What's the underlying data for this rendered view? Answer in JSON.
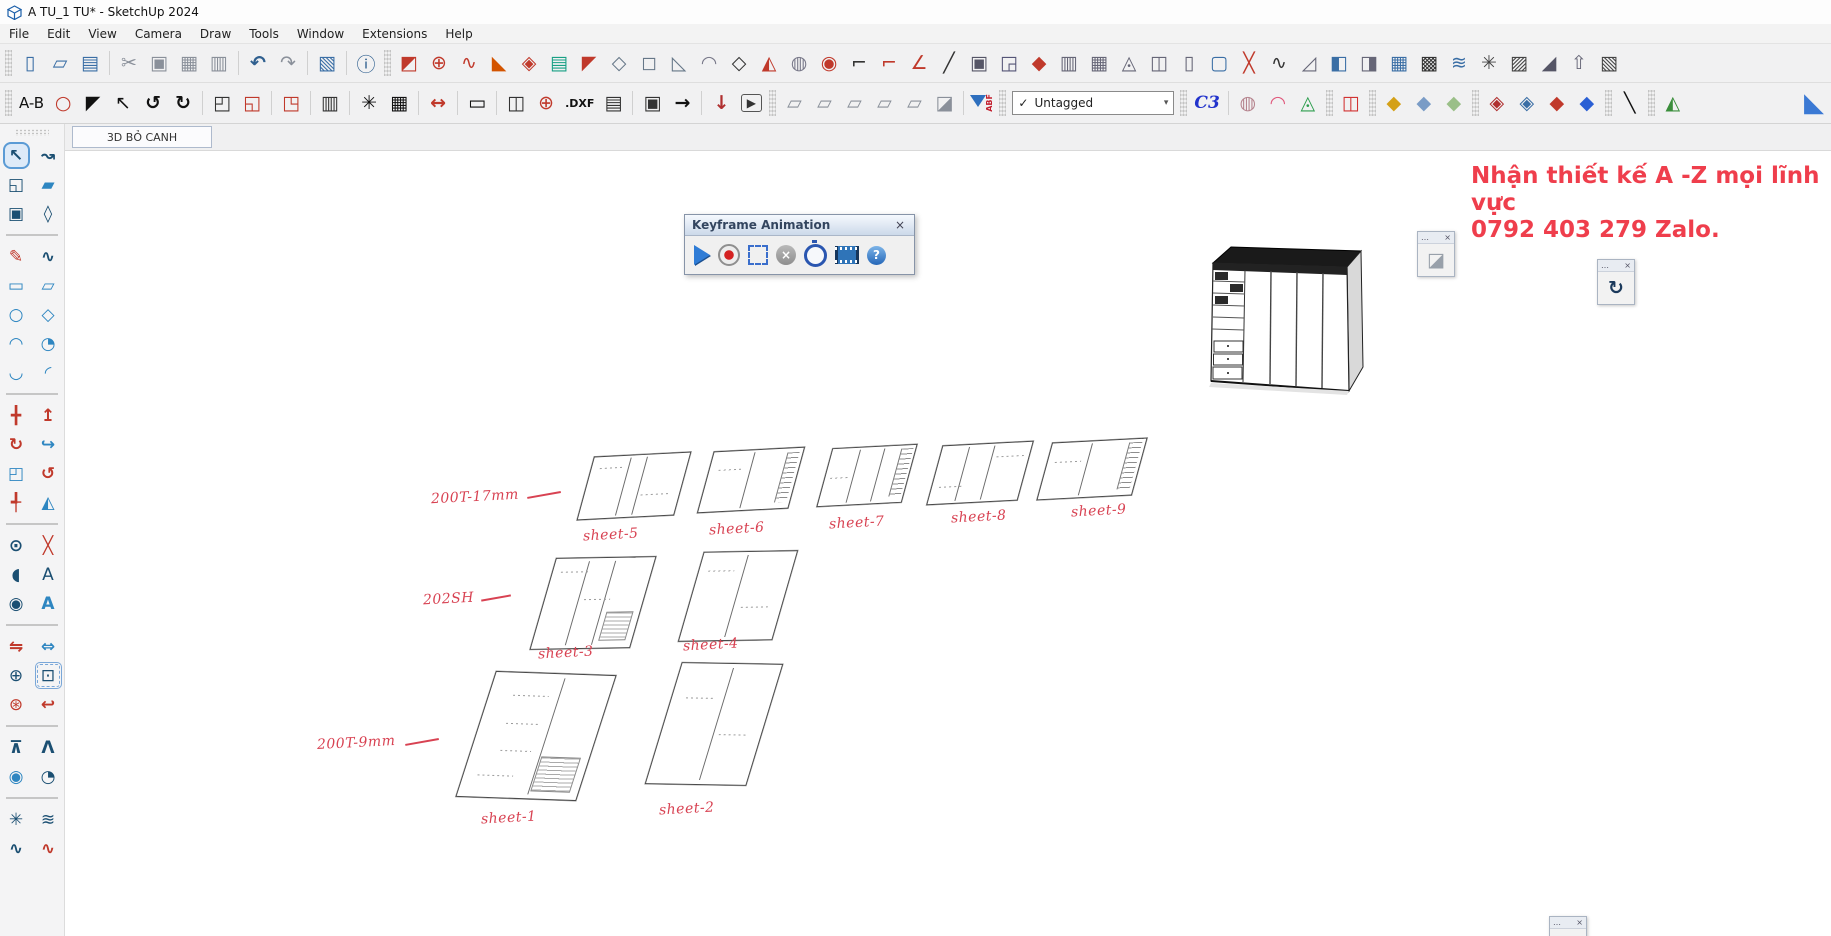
{
  "window": {
    "title": "A TU_1 TU* - SketchUp 2024"
  },
  "menubar": {
    "items": [
      "File",
      "Edit",
      "View",
      "Camera",
      "Draw",
      "Tools",
      "Window",
      "Extensions",
      "Help"
    ]
  },
  "toolbar_main": {
    "items": [
      {
        "t": "grip"
      },
      {
        "n": "new-file",
        "g": "▯",
        "c": "#3a6ea5"
      },
      {
        "n": "open-folder",
        "g": "▱",
        "c": "#3a6ea5"
      },
      {
        "n": "save",
        "g": "▤",
        "c": "#3a6ea5"
      },
      {
        "t": "sep"
      },
      {
        "n": "cut",
        "g": "✂",
        "c": "#8a909a"
      },
      {
        "n": "copy",
        "g": "▣",
        "c": "#8a909a"
      },
      {
        "n": "paste",
        "g": "▦",
        "c": "#8a909a"
      },
      {
        "n": "delete",
        "g": "▥",
        "c": "#8a909a"
      },
      {
        "t": "sep"
      },
      {
        "n": "undo",
        "g": "↶",
        "c": "#2f5f8f",
        "b": 1
      },
      {
        "n": "redo",
        "g": "↷",
        "c": "#8a909a"
      },
      {
        "t": "sep"
      },
      {
        "n": "print",
        "g": "▧",
        "c": "#3a6ea5"
      },
      {
        "t": "sep"
      },
      {
        "n": "model-info",
        "g": "ⓘ",
        "c": "#2f5f8f"
      },
      {
        "t": "grip"
      },
      {
        "n": "paste-in-place",
        "g": "◩",
        "c": "#c0392b"
      },
      {
        "n": "arc-add",
        "g": "⊕",
        "c": "#c0392b"
      },
      {
        "n": "bezier-curve",
        "g": "∿",
        "c": "#c0392b"
      },
      {
        "n": "eraser-wedge",
        "g": "◣",
        "c": "#d35400"
      },
      {
        "n": "weld-check",
        "g": "◈",
        "c": "#c0392b"
      },
      {
        "n": "layers-stack",
        "g": "▤",
        "c": "#18a085"
      },
      {
        "n": "axe-tool",
        "g": "◤",
        "c": "#c0392b"
      },
      {
        "n": "dashed-outline",
        "g": "◇",
        "c": "#667788"
      },
      {
        "n": "solid-blob",
        "g": "◻",
        "c": "#667788"
      },
      {
        "n": "blob-cut",
        "g": "◺",
        "c": "#667788"
      },
      {
        "n": "pipe-curve",
        "g": "◠",
        "c": "#778"
      },
      {
        "n": "wire-diamond",
        "g": "◇",
        "c": "#333"
      },
      {
        "n": "wedge-red",
        "g": "◭",
        "c": "#c0392b"
      },
      {
        "n": "cylinder-tool",
        "g": "◍",
        "c": "#778"
      },
      {
        "n": "sphere-pull",
        "g": "◉",
        "c": "#c0392b"
      },
      {
        "n": "corner-line",
        "g": "⌐",
        "c": "#333"
      },
      {
        "n": "corner-angle",
        "g": "⌐",
        "c": "#c0392b"
      },
      {
        "n": "angle-tool",
        "g": "∠",
        "c": "#c0392b"
      },
      {
        "n": "curve-swoosh",
        "g": "╱",
        "c": "#333"
      },
      {
        "n": "cube-frame",
        "g": "▣",
        "c": "#556"
      },
      {
        "n": "panel-fold",
        "g": "◲",
        "c": "#557"
      },
      {
        "n": "diamond-red",
        "g": "◆",
        "c": "#c0392b"
      },
      {
        "n": "columns-3d",
        "g": "▥",
        "c": "#667"
      },
      {
        "n": "pillars-3d",
        "g": "▦",
        "c": "#667"
      },
      {
        "n": "brush-fan",
        "g": "◬",
        "c": "#667"
      },
      {
        "n": "panel-pair",
        "g": "◫",
        "c": "#667"
      },
      {
        "n": "door-panel",
        "g": "▯",
        "c": "#667"
      },
      {
        "n": "frame-blue",
        "g": "▢",
        "c": "#3a6ea5"
      },
      {
        "n": "screw-cross",
        "g": "╳",
        "c": "#c0392b"
      },
      {
        "n": "zigzag-tool",
        "g": "∿",
        "c": "#333"
      },
      {
        "n": "ramp-3d",
        "g": "◿",
        "c": "#667"
      },
      {
        "n": "window-frame",
        "g": "◧",
        "c": "#3a6ea5"
      },
      {
        "n": "door-frame",
        "g": "◨",
        "c": "#667"
      },
      {
        "n": "building-3d",
        "g": "▦",
        "c": "#3a6ea5"
      },
      {
        "n": "weave-grid",
        "g": "▩",
        "c": "#333"
      },
      {
        "n": "chevron-stack",
        "g": "≋",
        "c": "#3a6ea5"
      },
      {
        "n": "knot-tool",
        "g": "✳",
        "c": "#444"
      },
      {
        "n": "slope-hatch",
        "g": "▨",
        "c": "#444"
      },
      {
        "n": "fan-lines",
        "g": "◢",
        "c": "#556"
      },
      {
        "n": "fold-arrow",
        "g": "⇧",
        "c": "#667"
      },
      {
        "n": "diag-hatch",
        "g": "▧",
        "c": "#444"
      }
    ]
  },
  "toolbar_second": {
    "items": [
      {
        "t": "grip"
      },
      {
        "t": "text",
        "n": "ab-label",
        "text": "A-B",
        "cls": "ab"
      },
      {
        "n": "zoom-region",
        "g": "○",
        "c": "#c0392b"
      },
      {
        "n": "stamp-tool",
        "g": "◤",
        "c": "#111"
      },
      {
        "n": "cursor-tool",
        "g": "↖",
        "c": "#111"
      },
      {
        "n": "rotate-ccw",
        "g": "↺",
        "c": "#111",
        "b": 1
      },
      {
        "n": "rotate-cw",
        "g": "↻",
        "c": "#111",
        "b": 1
      },
      {
        "t": "sep"
      },
      {
        "n": "section-plane",
        "g": "◰",
        "c": "#333"
      },
      {
        "n": "section-fill",
        "g": "◱",
        "c": "#c0392b"
      },
      {
        "t": "sep"
      },
      {
        "n": "section-cut",
        "g": "◳",
        "c": "#c0392b"
      },
      {
        "t": "sep"
      },
      {
        "n": "hatch-columns",
        "g": "▥",
        "c": "#333"
      },
      {
        "t": "sep"
      },
      {
        "n": "settings-gear",
        "g": "✳",
        "c": "#111",
        "b": 1
      },
      {
        "n": "table-grid",
        "g": "▦",
        "c": "#111"
      },
      {
        "t": "sep"
      },
      {
        "n": "move-dimension",
        "g": "↔",
        "c": "#c0392b",
        "b": 1
      },
      {
        "t": "sep"
      },
      {
        "n": "rect-frame",
        "g": "▭",
        "c": "#111",
        "b": 1
      },
      {
        "t": "sep"
      },
      {
        "n": "panel-views",
        "g": "◫",
        "c": "#333"
      },
      {
        "n": "target-circle",
        "g": "⊕",
        "c": "#c0392b"
      },
      {
        "t": "text",
        "n": "dxf-label",
        "text": ".DXF",
        "cls": "dxf"
      },
      {
        "n": "print-layout",
        "g": "▤",
        "c": "#333"
      },
      {
        "t": "sep"
      },
      {
        "n": "box-3d",
        "g": "▣",
        "c": "#333"
      },
      {
        "n": "arrow-right",
        "g": "→",
        "c": "#111",
        "b": 1
      },
      {
        "t": "sep"
      },
      {
        "n": "download-arrow",
        "g": "↓",
        "c": "#b03030",
        "b": 1
      },
      {
        "n": "play-video",
        "g": "▶",
        "c": "#333",
        "boxed": 1
      },
      {
        "t": "grip"
      },
      {
        "n": "view-iso",
        "g": "▱",
        "c": "#8a909a"
      },
      {
        "n": "view-top",
        "g": "▱",
        "c": "#8a909a"
      },
      {
        "n": "view-front",
        "g": "▱",
        "c": "#8a909a"
      },
      {
        "n": "view-side",
        "g": "▱",
        "c": "#8a909a"
      },
      {
        "n": "view-back",
        "g": "▱",
        "c": "#8a909a"
      },
      {
        "n": "camera-cube",
        "g": "◪",
        "c": "#8a909a"
      },
      {
        "t": "sep"
      },
      {
        "t": "funnel",
        "n": "abf-filter",
        "label": "ABF"
      },
      {
        "t": "grip"
      },
      {
        "t": "dropdown",
        "n": "tags-dropdown",
        "check": "✓",
        "value": "Untagged",
        "arrow": "▾"
      },
      {
        "t": "grip"
      },
      {
        "t": "text",
        "n": "c3-logo",
        "text": "C3",
        "cls": "c3",
        "c": "#2233cc"
      },
      {
        "t": "sep"
      },
      {
        "n": "head-sculpt",
        "g": "◍",
        "c": "#b5838d"
      },
      {
        "n": "pink-lasso",
        "g": "◠",
        "c": "#e0567a",
        "b": 1
      },
      {
        "n": "prism-green",
        "g": "◬",
        "c": "#2e9e4f"
      },
      {
        "t": "grip"
      },
      {
        "n": "marker-red",
        "g": "◫",
        "c": "#d23333"
      },
      {
        "t": "grip"
      },
      {
        "n": "box-yellow",
        "g": "◆",
        "c": "#d4a017"
      },
      {
        "n": "box-blue",
        "g": "◆",
        "c": "#7a9cc6"
      },
      {
        "n": "box-green",
        "g": "◆",
        "c": "#9abf88"
      },
      {
        "t": "grip"
      },
      {
        "n": "s-flag-red",
        "g": "◈",
        "c": "#b03030"
      },
      {
        "n": "s-hatch-blue",
        "g": "◈",
        "c": "#3a6ea5"
      },
      {
        "n": "s-diamond-red",
        "g": "◆",
        "c": "#c0392b"
      },
      {
        "n": "s-box-blue",
        "g": "◆",
        "c": "#2a5fd4"
      },
      {
        "t": "grip"
      },
      {
        "n": "line-draw",
        "g": "╲",
        "c": "#111"
      },
      {
        "t": "grip"
      },
      {
        "n": "symmetry-leaves",
        "g": "◭",
        "c": "#3a8e3b"
      },
      {
        "t": "spacer"
      },
      {
        "n": "blue-flat-arrow",
        "g": "◣",
        "c": "#3b79d4",
        "big": 1
      }
    ]
  },
  "scene_tab": {
    "label": "3D BỎ CANH"
  },
  "palette": {
    "groups": [
      [
        [
          {
            "n": "select",
            "g": "↖",
            "c": "#1b4f72",
            "active": 1,
            "b": 1
          },
          {
            "n": "lasso",
            "g": "↝",
            "c": "#1b4f72",
            "b": 1
          }
        ],
        [
          {
            "n": "paint-bucket",
            "g": "◱",
            "c": "#1b4f72"
          },
          {
            "n": "eraser",
            "g": "▰",
            "c": "#2e86c1"
          }
        ],
        [
          {
            "n": "components",
            "g": "▣",
            "c": "#1b4f72"
          },
          {
            "n": "tag",
            "g": "◊",
            "c": "#1b4f72",
            "b": 1
          }
        ]
      ],
      [
        [
          {
            "n": "line",
            "g": "✎",
            "c": "#c0392b"
          },
          {
            "n": "freehand",
            "g": "∿",
            "c": "#1b4f72",
            "b": 1
          }
        ],
        [
          {
            "n": "rectangle",
            "g": "▭",
            "c": "#2e86c1",
            "b": 1
          },
          {
            "n": "rotated-rectangle",
            "g": "▱",
            "c": "#2e86c1",
            "b": 1
          }
        ],
        [
          {
            "n": "circle",
            "g": "○",
            "c": "#2e86c1",
            "b": 1
          },
          {
            "n": "polygon",
            "g": "◇",
            "c": "#2e86c1",
            "b": 1
          }
        ],
        [
          {
            "n": "arc",
            "g": "◠",
            "c": "#2e86c1",
            "b": 1
          },
          {
            "n": "pie",
            "g": "◔",
            "c": "#2e86c1"
          }
        ],
        [
          {
            "n": "arc-2pt",
            "g": "◡",
            "c": "#2e86c1",
            "b": 1
          },
          {
            "n": "arc-3pt",
            "g": "◜",
            "c": "#2e86c1",
            "b": 1
          }
        ]
      ],
      [
        [
          {
            "n": "move",
            "g": "╋",
            "c": "#c0392b"
          },
          {
            "n": "push-pull",
            "g": "↥",
            "c": "#c0392b",
            "b": 1
          }
        ],
        [
          {
            "n": "rotate",
            "g": "↻",
            "c": "#c0392b",
            "b": 1
          },
          {
            "n": "follow-me",
            "g": "↪",
            "c": "#2e86c1",
            "b": 1
          }
        ],
        [
          {
            "n": "scale",
            "g": "◰",
            "c": "#2e86c1"
          },
          {
            "n": "offset",
            "g": "↺",
            "c": "#c0392b",
            "b": 1
          }
        ],
        [
          {
            "n": "axes",
            "g": "╃",
            "c": "#c0392b"
          },
          {
            "n": "mirror",
            "g": "◭",
            "c": "#2e86c1"
          }
        ]
      ],
      [
        [
          {
            "n": "tape-measure",
            "g": "⊙",
            "c": "#1b4f72",
            "b": 1
          },
          {
            "n": "dimension",
            "g": "╳",
            "c": "#c0392b"
          }
        ],
        [
          {
            "n": "protractor",
            "g": "◖",
            "c": "#1b4f72"
          },
          {
            "n": "text",
            "g": "A",
            "c": "#1b4f72"
          }
        ],
        [
          {
            "n": "axes-compass",
            "g": "◉",
            "c": "#1b4f72"
          },
          {
            "n": "3d-text",
            "g": "A",
            "c": "#2e86c1",
            "b": 1
          }
        ]
      ],
      [
        [
          {
            "n": "orbit-flip",
            "g": "⇋",
            "c": "#c0392b",
            "b": 1
          },
          {
            "n": "pan",
            "g": "⇔",
            "c": "#2e86c1",
            "b": 1
          }
        ],
        [
          {
            "n": "zoom",
            "g": "⊕",
            "c": "#1b4f72"
          },
          {
            "n": "zoom-window",
            "g": "⊡",
            "c": "#1b4f72",
            "sel": 1
          }
        ],
        [
          {
            "n": "zoom-extents",
            "g": "⊛",
            "c": "#c0392b"
          },
          {
            "n": "previous-view",
            "g": "↩",
            "c": "#c0392b",
            "b": 1
          }
        ]
      ],
      [
        [
          {
            "n": "position-camera",
            "g": "⊼",
            "c": "#1b4f72",
            "b": 1
          },
          {
            "n": "walk",
            "g": "Λ",
            "c": "#1b4f72",
            "b": 1
          }
        ],
        [
          {
            "n": "look-around",
            "g": "◉",
            "c": "#2e86c1"
          },
          {
            "n": "look-target",
            "g": "◔",
            "c": "#1b4f72"
          }
        ]
      ],
      [
        [
          {
            "n": "ext-spiral",
            "g": "✳",
            "c": "#1b4f72"
          },
          {
            "n": "ext-curves",
            "g": "≋",
            "c": "#1b4f72"
          }
        ],
        [
          {
            "n": "ext-weld",
            "g": "∿",
            "c": "#1b4f72",
            "b": 1
          },
          {
            "n": "ext-profile",
            "g": "∿",
            "c": "#c0392b",
            "b": 1
          }
        ]
      ]
    ]
  },
  "canvas": {
    "keyframe_dialog": {
      "title": "Keyframe Animation",
      "close": "×",
      "buttons": [
        {
          "n": "play-button",
          "cls": "play",
          "g": ""
        },
        {
          "n": "record-button",
          "cls": "record",
          "g": ""
        },
        {
          "n": "select-keyframes-button",
          "cls": "selectk",
          "g": ""
        },
        {
          "n": "stop-button",
          "cls": "stop",
          "g": "×"
        },
        {
          "n": "timer-button",
          "cls": "timer",
          "g": ""
        },
        {
          "n": "export-movie-button",
          "cls": "film",
          "g": ""
        },
        {
          "n": "help-button",
          "cls": "help",
          "g": "?"
        }
      ]
    },
    "watermark": {
      "line1": "Nhận thiết kế A -Z mọi lĩnh vực",
      "line2": "0792 403 279 Zalo.",
      "color": "#ef3e4c"
    },
    "group_labels": [
      {
        "text": "200T-17mm"
      },
      {
        "text": "202SH"
      },
      {
        "text": "200T-9mm"
      }
    ],
    "sheets": [
      {
        "label": "sheet-1"
      },
      {
        "label": "sheet-2"
      },
      {
        "label": "sheet-3"
      },
      {
        "label": "sheet-4"
      },
      {
        "label": "sheet-5"
      },
      {
        "label": "sheet-6"
      },
      {
        "label": "sheet-7"
      },
      {
        "label": "sheet-8"
      },
      {
        "label": "sheet-9"
      }
    ],
    "mini": {
      "dots": "…",
      "close": "×",
      "panel_a_icon": "◪",
      "panel_b_icon": "↻"
    }
  }
}
